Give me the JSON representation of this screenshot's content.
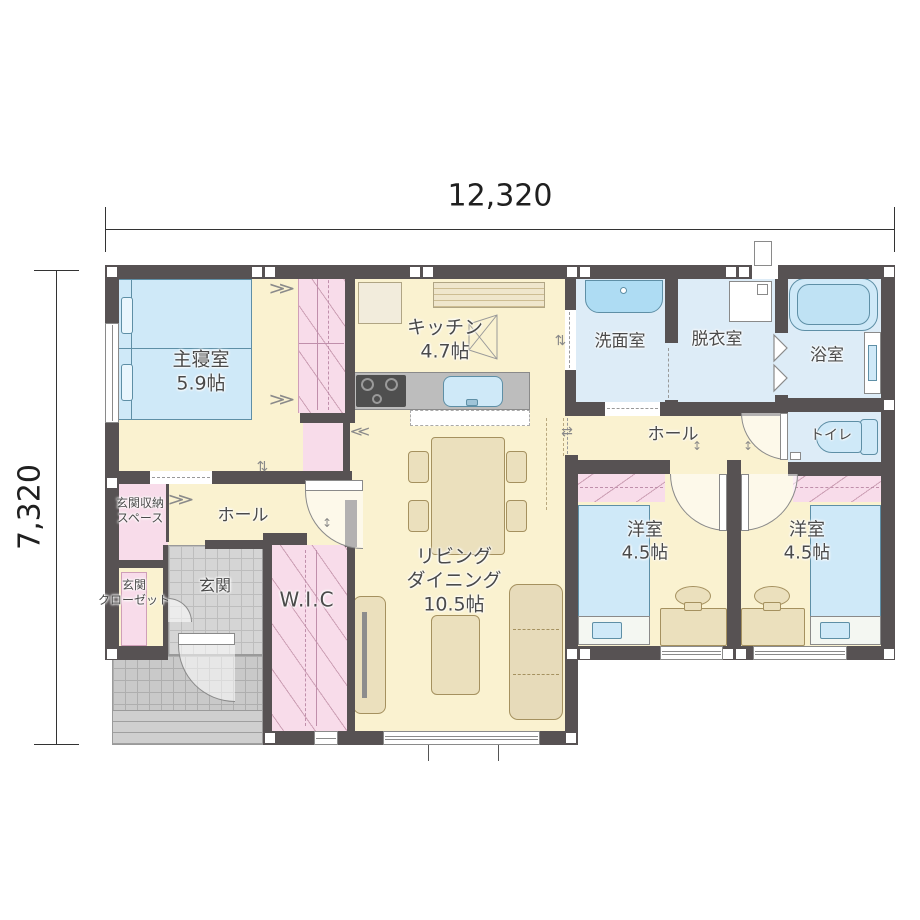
{
  "dimensions": {
    "width": "12,320",
    "height": "7,320"
  },
  "rooms": {
    "master_bedroom": {
      "name": "主寝室",
      "size": "5.9帖"
    },
    "kitchen": {
      "name": "キッチン",
      "size": "4.7帖"
    },
    "washroom": {
      "name": "洗面室"
    },
    "dressing_room": {
      "name": "脱衣室"
    },
    "bathroom": {
      "name": "浴室"
    },
    "hall_east": {
      "name": "ホール"
    },
    "toilet": {
      "name": "トイレ"
    },
    "western_room_left": {
      "name": "洋室",
      "size": "4.5帖"
    },
    "western_room_right": {
      "name": "洋室",
      "size": "4.5帖"
    },
    "living_dining": {
      "name_line1": "リビング",
      "name_line2": "ダイニング",
      "size": "10.5帖"
    },
    "wic": {
      "name": "W.I.C"
    },
    "hall_west": {
      "name": "ホール"
    },
    "entrance_storage": {
      "name_line1": "玄関収納",
      "name_line2": "スペース"
    },
    "entrance_closet": {
      "name_line1": "玄関",
      "name_line2": "クローゼット"
    },
    "entrance": {
      "name": "玄関"
    }
  },
  "icons": {
    "slide_arrow": "⇄",
    "swing_arrow": "↕",
    "shelf_chevron_right": "≫",
    "shelf_chevron_left": "≪"
  },
  "colors": {
    "wall": "#575253",
    "floor_cream": "#faf2d0",
    "wet_floor": "#ddecf7",
    "closet_pink": "#f8dcea",
    "fixture_blue": "#cfe9f8",
    "furniture_tan": "#ebe0bd",
    "tile_gray": "#d5d5d5"
  }
}
